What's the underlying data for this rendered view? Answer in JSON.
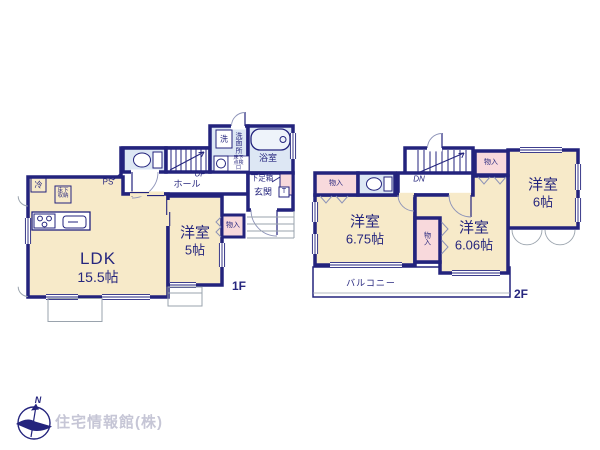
{
  "floor1": {
    "label": "1F",
    "ldk": {
      "name": "LDK",
      "size": "15.5帖"
    },
    "bedroom": {
      "name": "洋室",
      "size": "5帖"
    },
    "hall": "ホール",
    "stairs": "UP",
    "ps": "PS",
    "fridge": "冷",
    "underfloor_storage": "床下収納",
    "washer": "洗",
    "washroom": "洗面所",
    "inspection_hatch": "床下点検口",
    "bath": "浴室",
    "shoebox": "下足箱",
    "entrance": "玄関",
    "t_mark": "T",
    "closet": "物入"
  },
  "floor2": {
    "label": "2F",
    "bedroom1": {
      "name": "洋室",
      "size": "6.75帖"
    },
    "bedroom2": {
      "name": "洋室",
      "size": "6.06帖"
    },
    "bedroom3": {
      "name": "洋室",
      "size": "6帖"
    },
    "balcony": "バルコニー",
    "stairs": "DN",
    "closet_left": "物入",
    "closet_top": "物入",
    "closet_mid": "物入"
  },
  "footer": {
    "company": "住宅情報館(株)",
    "compass_north": "N"
  },
  "colors": {
    "wall": "#23237d",
    "room_fill": "#f7eac9",
    "closet_fill": "#f8d9dc",
    "wet_fill": "#dde7f4",
    "text": "#26267e",
    "gray_line": "#9aa3ad",
    "company_text": "#c6c6d6"
  }
}
